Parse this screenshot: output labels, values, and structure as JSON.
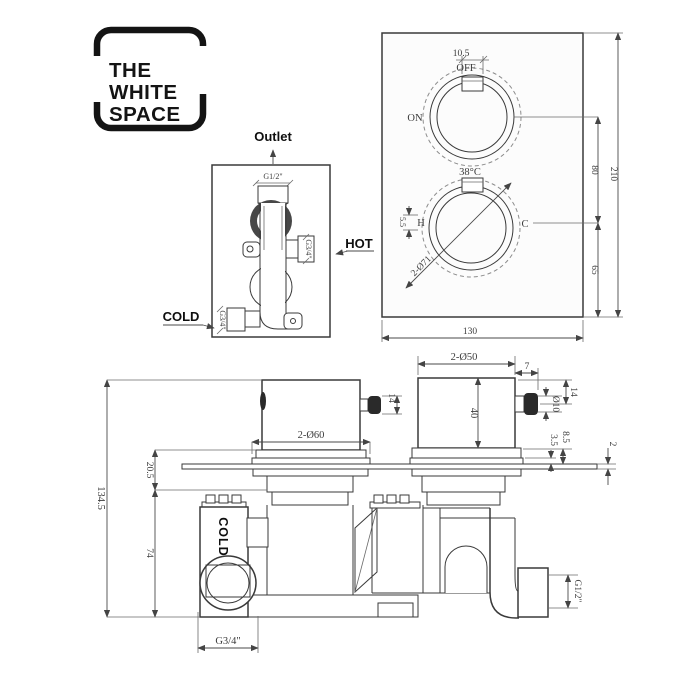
{
  "brand": {
    "line1": "THE",
    "line2": "WHITE",
    "line3": "SPACE"
  },
  "side_view": {
    "outlet": "Outlet",
    "outlet_thread": "G1/2\"",
    "hot": "HOT",
    "hot_thread": "G3/4\"",
    "cold": "COLD",
    "cold_thread": "G3/4\""
  },
  "front_view": {
    "dim_tab": "10.5",
    "off": "OFF",
    "on": "ON",
    "temp": "38°C",
    "hot_mark": "H",
    "cold_mark": "C",
    "dim_handle": "5.5",
    "dim_dials": "2-Ø71",
    "dim_spacing": "80",
    "dim_lower": "65",
    "dim_height": "210",
    "dim_width": "130"
  },
  "section_view": {
    "dim_total": "134.5",
    "dim_recess": "20.5",
    "dim_body": "74",
    "dim_left_knob": "2-Ø60",
    "dim_left_pin": "14",
    "dim_right_knob": "2-Ø50",
    "dim_pin_offset": "7",
    "dim_right_pin": "14",
    "dim_pin_dia": "Ø10",
    "dim_knob_height": "40",
    "dim_depth_a": "8.5",
    "dim_depth_b": "3.5",
    "dim_plate": "2",
    "cold": "COLD",
    "cold_thread": "G3/4\"",
    "outlet_thread": "G1/2\""
  }
}
